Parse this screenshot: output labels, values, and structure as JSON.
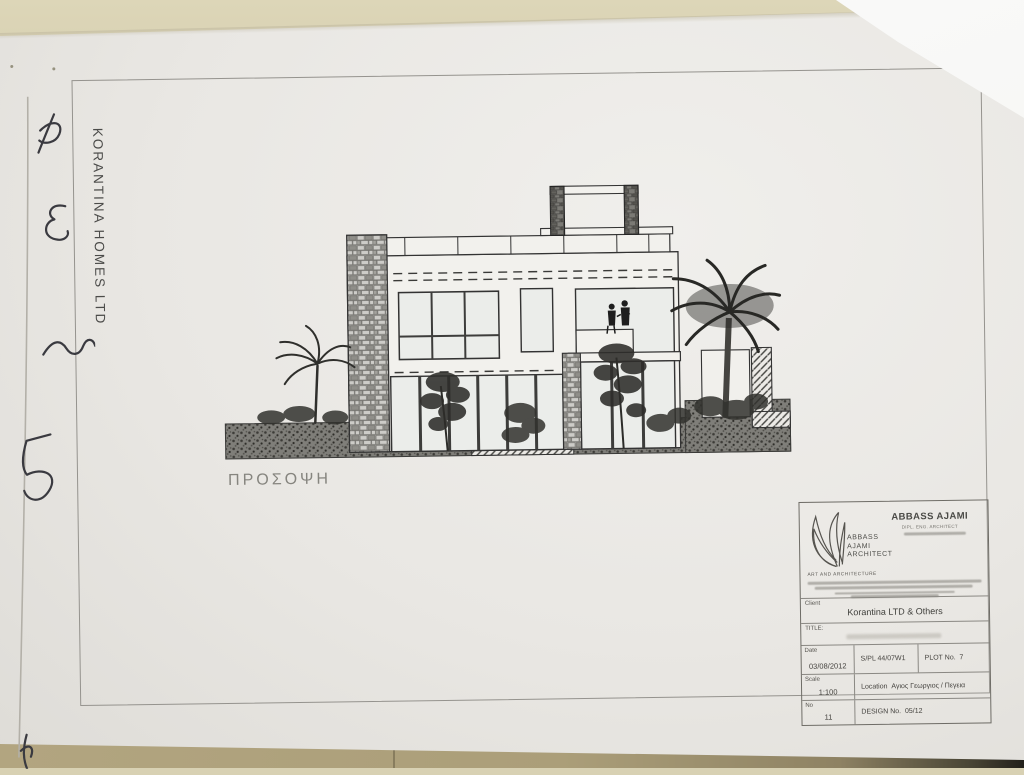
{
  "scene": {
    "wall_color": "#d8d1b3",
    "floor_color": "#ab9e79",
    "paper_color": "#e9e7e3",
    "corner_shadow_color": "#211f1a"
  },
  "margin": {
    "side_text": "KORANTINA HOMES LTD"
  },
  "drawing": {
    "caption": "ΠΡΟΣΟΨΗ"
  },
  "title_block": {
    "firm": {
      "logo_line1": "ABBASS",
      "logo_line2": "AJAMI",
      "logo_line3": "ARCHITECT",
      "name": "ABBASS AJAMI",
      "credential": "DIPL. ENG. ARCHITECT",
      "tagline": "ART AND ARCHITECTURE"
    },
    "client": {
      "label": "Client",
      "value": "Korantina LTD & Others"
    },
    "title": {
      "label": "TITLE:"
    },
    "date": {
      "label": "Date",
      "value": "03/08/2012"
    },
    "spl": {
      "value": "S/PL 44/07W1"
    },
    "plot": {
      "label": "PLOT No.",
      "value": "7"
    },
    "scale": {
      "label": "Scale",
      "value": "1:100"
    },
    "location": {
      "label": "Location",
      "value": "Αγιος Γεωργιος / Πεγεια"
    },
    "no": {
      "label": "No",
      "value": "11"
    },
    "design": {
      "label": "DESIGN No.",
      "value": "05/12"
    }
  }
}
